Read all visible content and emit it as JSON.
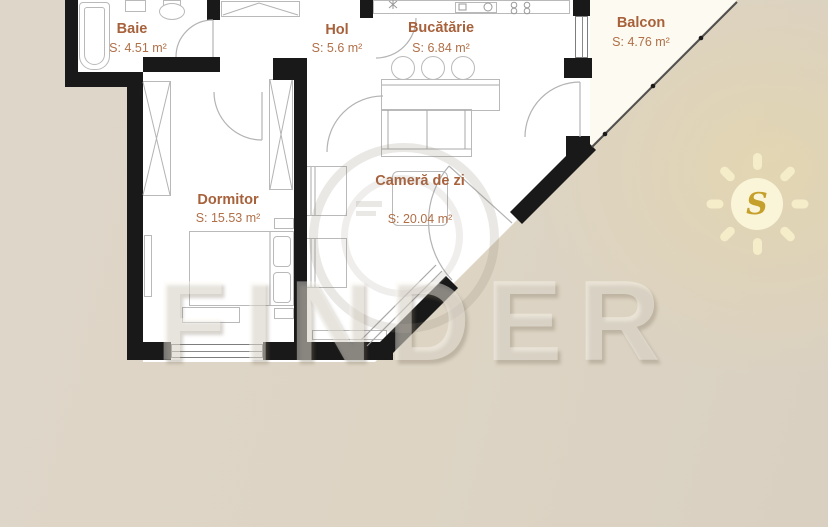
{
  "plan": {
    "rooms": [
      {
        "id": "baie",
        "name": "Baie",
        "area": "S: 4.51 m²"
      },
      {
        "id": "hol",
        "name": "Hol",
        "area": "S: 5.6 m²"
      },
      {
        "id": "bucatarie",
        "name": "Bucătărie",
        "area": "S: 6.84 m²"
      },
      {
        "id": "balcon",
        "name": "Balcon",
        "area": "S: 4.76 m²"
      },
      {
        "id": "dormitor",
        "name": "Dormitor",
        "area": "S: 15.53 m²"
      },
      {
        "id": "camera_de_zi",
        "name": "Cameră de zi",
        "area": "S: 20.04 m²"
      }
    ],
    "compass": {
      "letter": "S"
    },
    "watermark": {
      "text": "FINDER"
    },
    "colors": {
      "label_text": "#a7613b",
      "wall": "#191919",
      "background_tan": "#dcd3c2",
      "interior": "#ffffff",
      "balcony_fill": "#fcfaf1",
      "sun_gold": "#c6a02c",
      "sun_fill": "#faf4d8"
    }
  }
}
